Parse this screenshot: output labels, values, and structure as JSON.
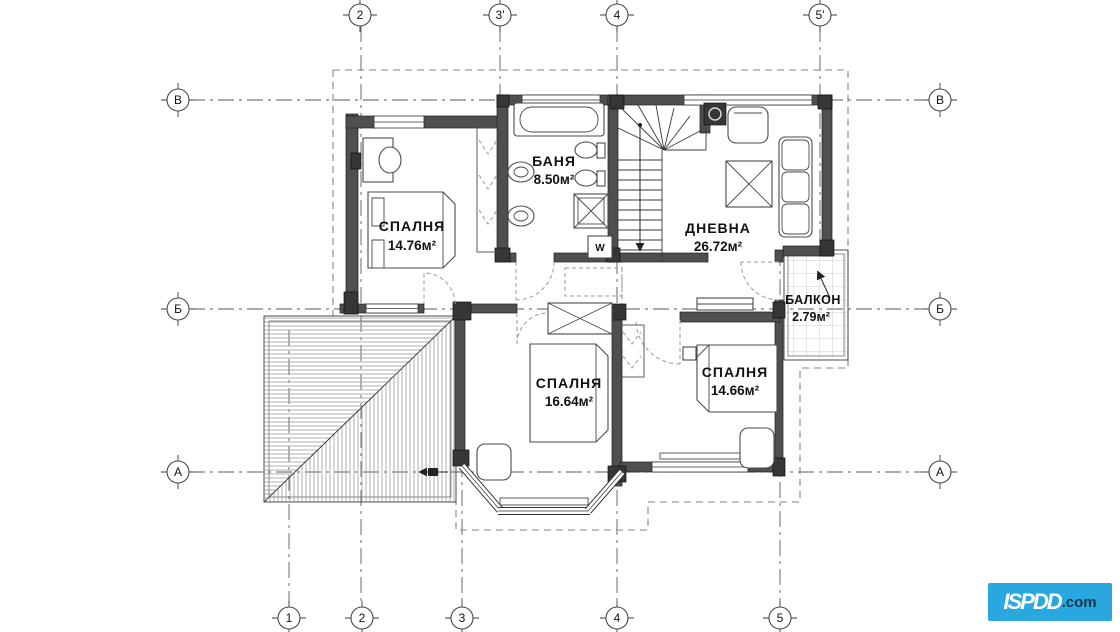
{
  "page": {
    "background": "#ffffff"
  },
  "plan": {
    "rooms": [
      {
        "key": "bedroom-1",
        "name": "СПАЛНЯ",
        "area": "14.76м²"
      },
      {
        "key": "bathroom",
        "name": "БАНЯ",
        "area": "8.50м²"
      },
      {
        "key": "living-room",
        "name": "ДНЕВНА",
        "area": "26.72м²"
      },
      {
        "key": "balcony",
        "name": "БАЛКОН",
        "area": "2.79м²"
      },
      {
        "key": "bedroom-2",
        "name": "СПАЛНЯ",
        "area": "16.64м²"
      },
      {
        "key": "bedroom-3",
        "name": "СПАЛНЯ",
        "area": "14.66м²"
      }
    ],
    "grid_axes": {
      "top": [
        "2",
        "3'",
        "4",
        "5'"
      ],
      "bottom": [
        "1",
        "2",
        "3",
        "4",
        "5"
      ],
      "left": [
        "В",
        "Б",
        "А"
      ],
      "right": [
        "В",
        "Б",
        "А"
      ]
    },
    "symbols": {
      "washing_machine": "W"
    }
  },
  "logo": {
    "brand": "ISPDD",
    "tld": ".com",
    "background": "#29a8e0"
  }
}
